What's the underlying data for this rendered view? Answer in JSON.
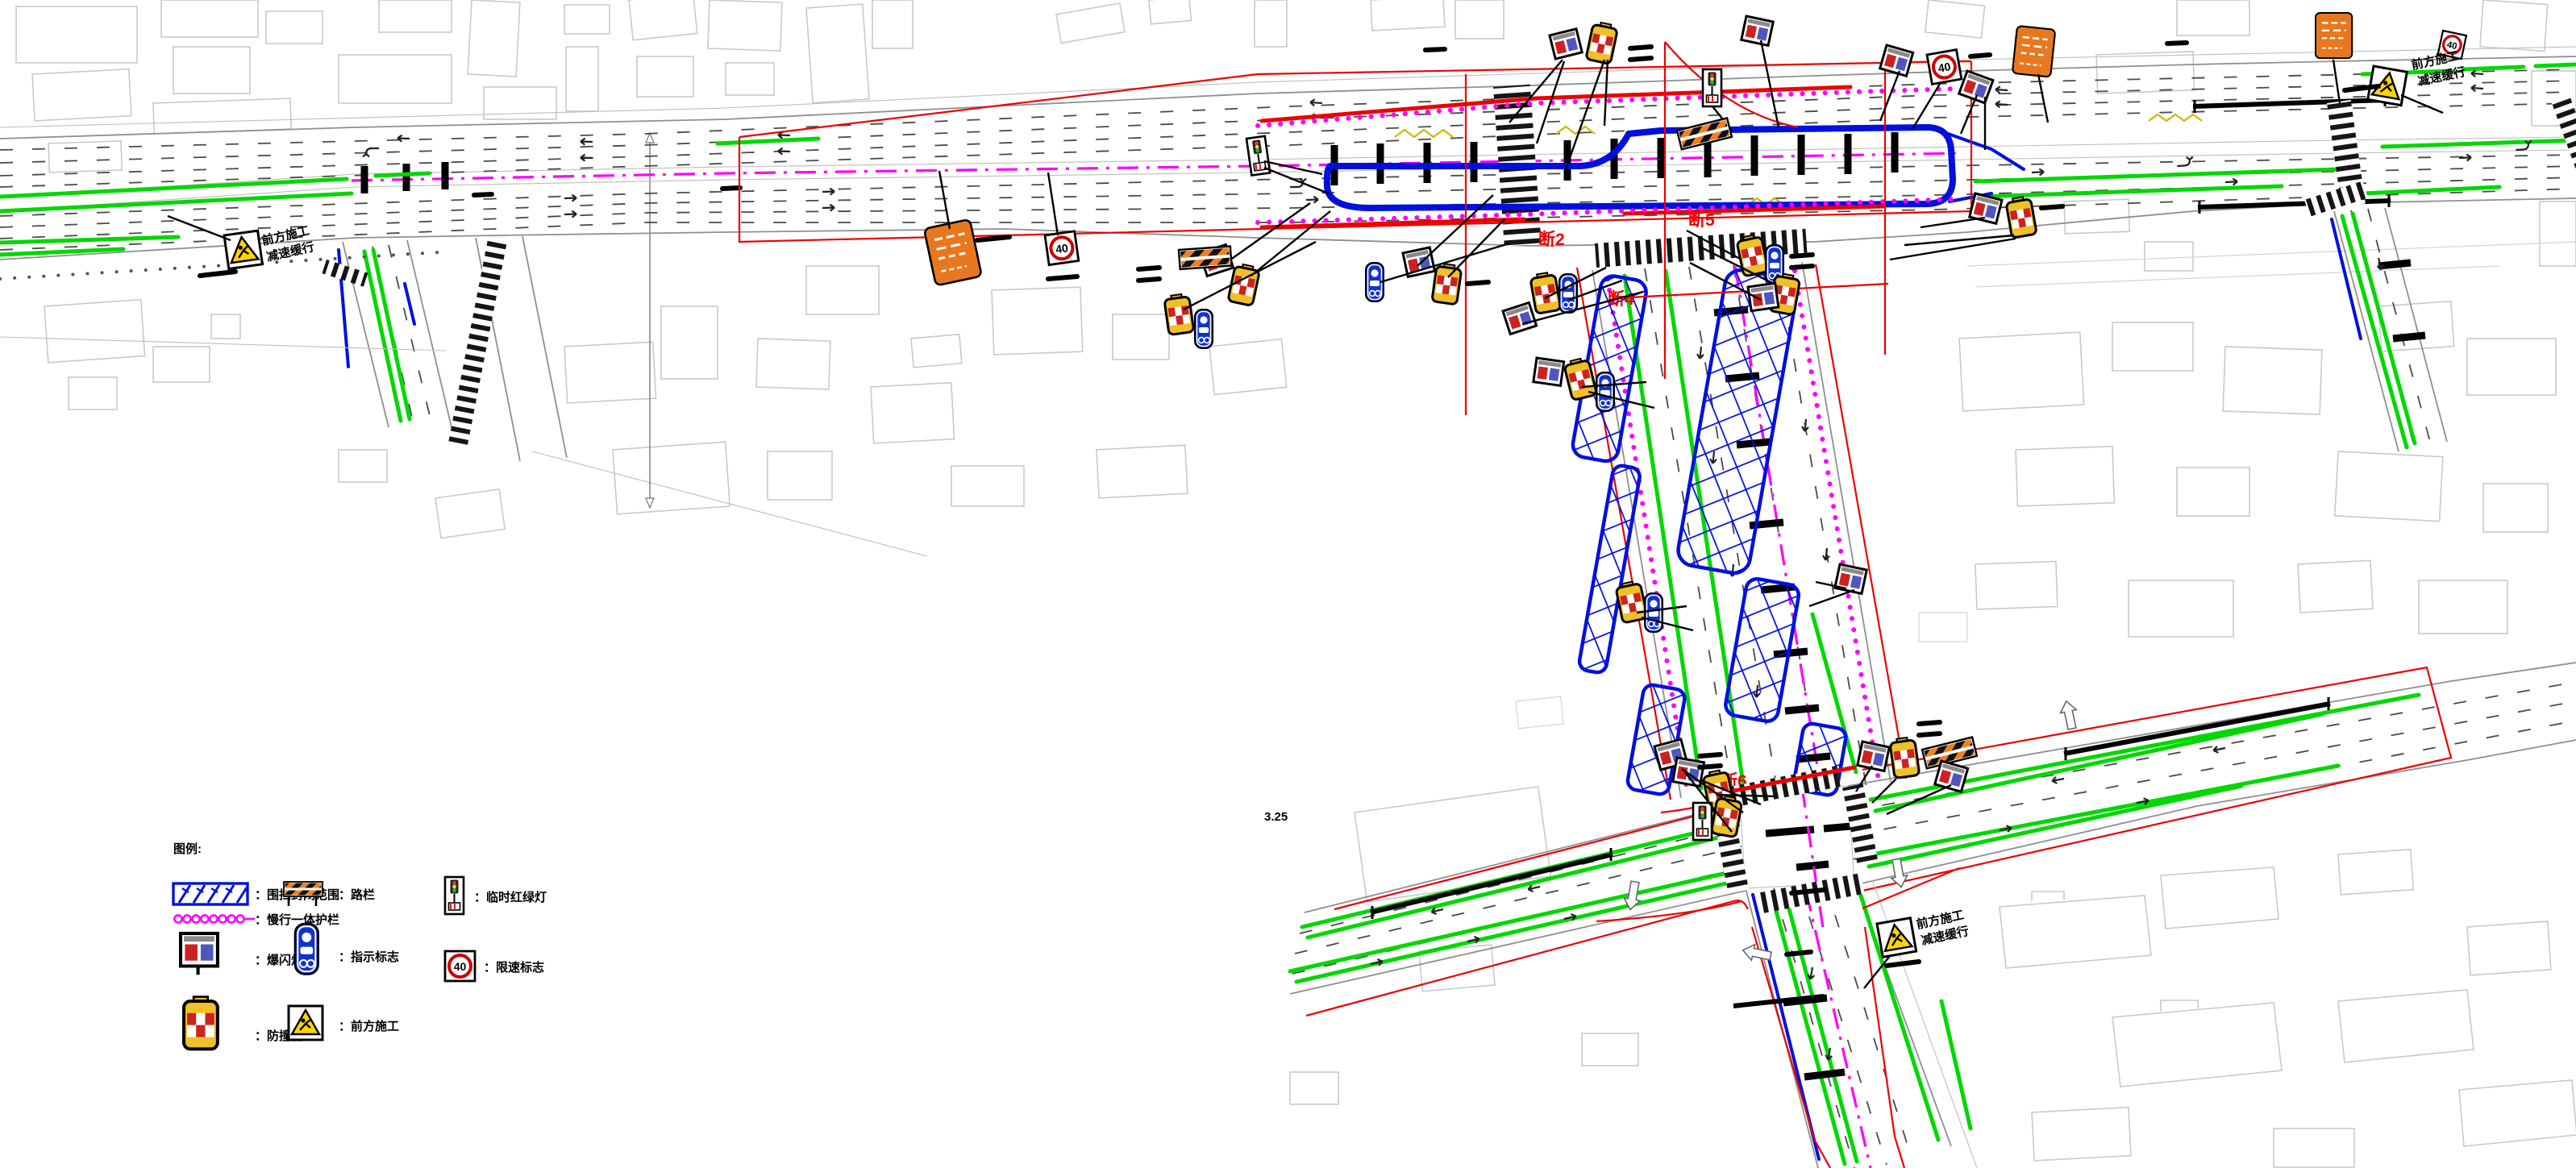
{
  "drawing": {
    "legend": {
      "title": "图例:",
      "items": [
        {
          "id": "enclosure",
          "label": "：围挡封闭范围"
        },
        {
          "id": "slow-barrier",
          "label": "：慢行一体护栏"
        },
        {
          "id": "strobe-light",
          "label": "：爆闪灯"
        },
        {
          "id": "crash-barrel",
          "label": "：防撞桶"
        },
        {
          "id": "road-barrier",
          "label": "：路栏"
        },
        {
          "id": "guide-sign",
          "label": "：指示标志"
        },
        {
          "id": "construction-ahead",
          "label": "：前方施工"
        },
        {
          "id": "temp-signal",
          "label": "：临时红绿灯"
        },
        {
          "id": "speed-limit",
          "label": "：限速标志"
        }
      ]
    },
    "callouts": {
      "construction_ahead": "前方施工",
      "slow_down": "减速缓行"
    },
    "signs": {
      "speed_limit_value": "40"
    },
    "section_labels": [
      {
        "text": "断2"
      },
      {
        "text": "断5"
      },
      {
        "text": "断4"
      },
      {
        "text": "断6"
      }
    ],
    "annotations": {
      "elevation": "3.25"
    },
    "colors": {
      "enclosure_blue": "#0010dd",
      "slow_barrier_magenta": "#ff00ff",
      "road_edge_green": "#00d800",
      "boundary_red": "#ee0000",
      "barrier_orange": "#f08020",
      "barrel_yellow": "#f0c028",
      "building_gray": "#c9c9c9"
    }
  }
}
